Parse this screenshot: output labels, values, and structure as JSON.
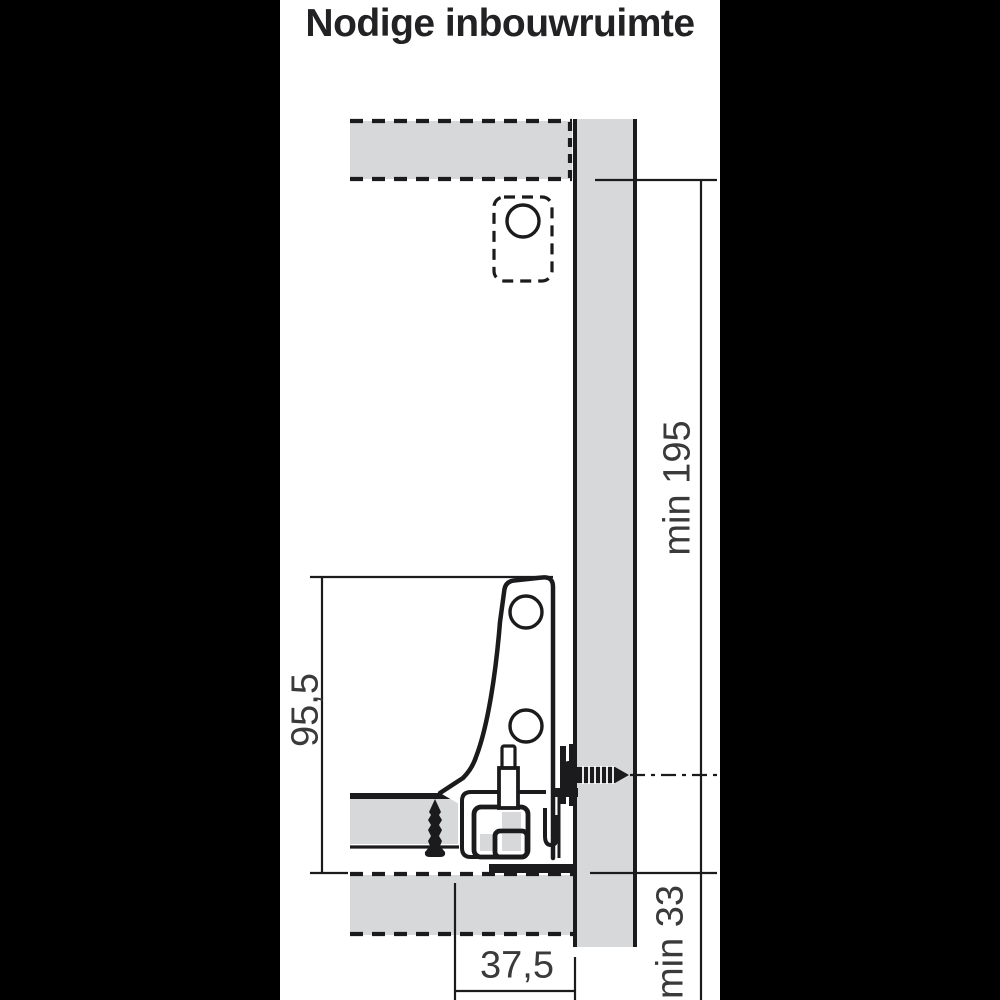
{
  "title": "Nodige inbouwruimte",
  "dimensions": {
    "cabinet_inner_height": "min 195",
    "drawer_side_height": "95,5",
    "bottom_clearance": "min 33",
    "back_offset": "37,5"
  },
  "colors": {
    "background": "#000000",
    "sheet": "#ffffff",
    "panel_gray": "#d7d8da",
    "line": "#1b1b1d",
    "label_text": "#3a3a3a",
    "title_text": "#222224"
  }
}
